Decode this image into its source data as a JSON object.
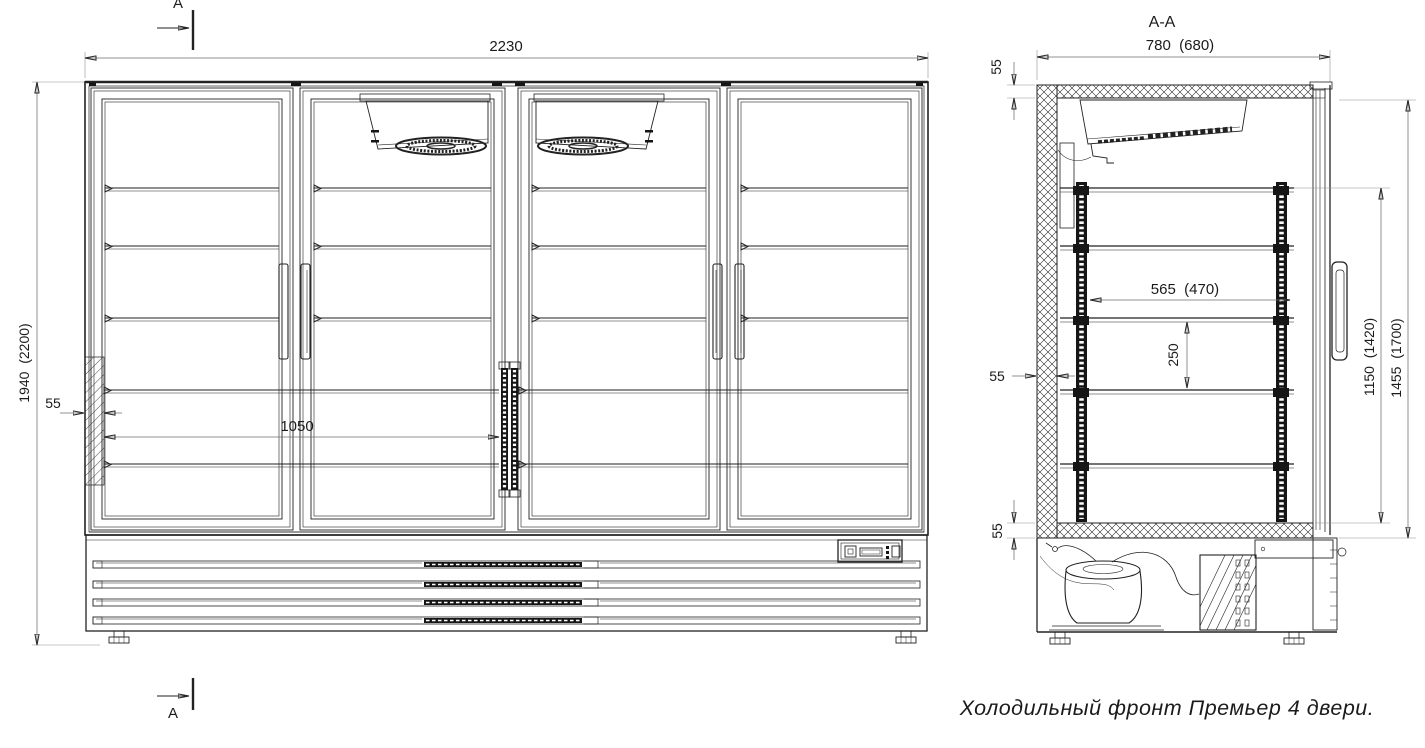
{
  "marks": {
    "top": "A",
    "bottom": "A"
  },
  "front": {
    "width": "2230",
    "height": "1940  (2200)",
    "wall": "55",
    "shelf_width": "1050"
  },
  "section": {
    "title": "A-A",
    "depth": "780  (680)",
    "top_wall": "55",
    "back_wall": "55",
    "bottom_wall": "55",
    "shelf_depth": "565  (470)",
    "shelf_pitch": "250",
    "inner_height": "1150  (1420)",
    "overall_height": "1455  (1700)"
  },
  "caption": "Холодильный фронт Премьер 4 двери."
}
